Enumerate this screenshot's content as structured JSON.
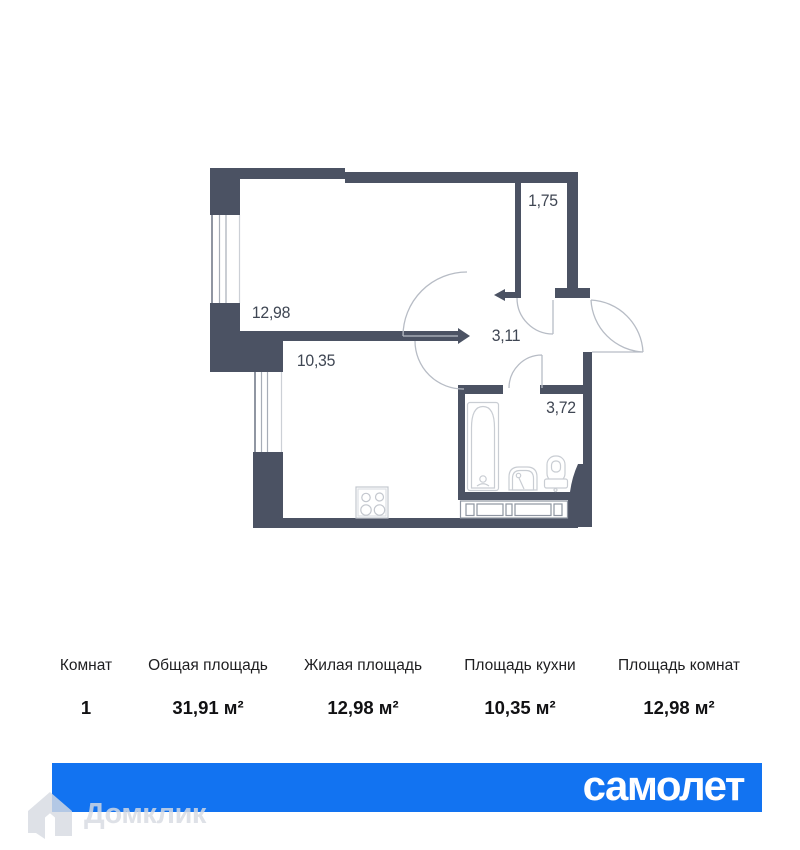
{
  "plan": {
    "rooms": [
      {
        "id": "living",
        "area": "12,98"
      },
      {
        "id": "kitchen",
        "area": "10,35"
      },
      {
        "id": "hallway",
        "area": "3,11"
      },
      {
        "id": "wardrobe",
        "area": "1,75"
      },
      {
        "id": "bathroom",
        "area": "3,72"
      }
    ],
    "fixtures": [
      "bathtub-icon",
      "sink-icon",
      "toilet-icon",
      "stove-icon",
      "kitchen-counter"
    ]
  },
  "table": {
    "columns": [
      {
        "label": "Комнат",
        "value": "1"
      },
      {
        "label": "Общая площадь",
        "value": "31,91 м²"
      },
      {
        "label": "Жилая площадь",
        "value": "12,98 м²"
      },
      {
        "label": "Площадь кухни",
        "value": "10,35 м²"
      },
      {
        "label": "Площадь комнат",
        "value": "12,98 м²"
      }
    ]
  },
  "banner": {
    "brand": "самолет",
    "color": "#1273f1"
  },
  "watermark": {
    "label": "Домклик"
  },
  "colors": {
    "wall": "#4b5263",
    "fixture_line": "#c9cdd3",
    "arc_line": "#b7bcc5",
    "label_text": "#3f4653"
  }
}
